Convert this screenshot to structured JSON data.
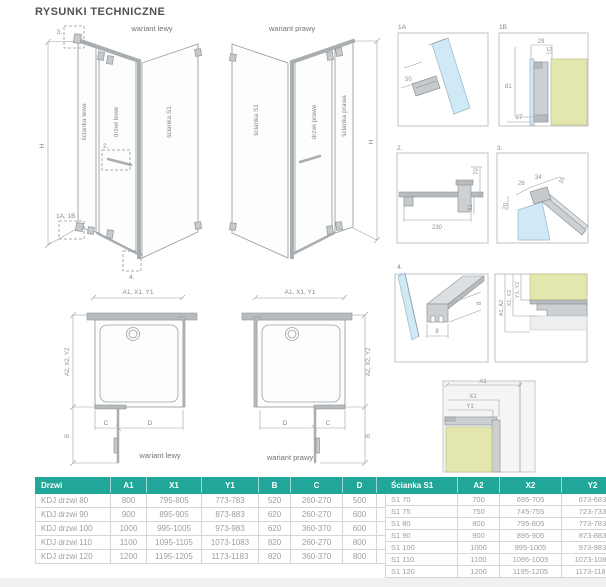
{
  "page": {
    "title": "RYSUNKI TECHNICZNE"
  },
  "colors": {
    "accent": "#21a69a",
    "glass": "#cfe9f6",
    "wall": "#e4e7ad",
    "line": "#9aa0a3"
  },
  "views": {
    "left3d": {
      "variant_label": "wariant lewy",
      "panel_left": "ścianka lewa",
      "panel_door": "drzwi lewe",
      "panel_s1": "ścianka S1",
      "dim_height": "H",
      "callout_top": "3.",
      "callout_handle": "2.",
      "callout_hinge": "1A, 1B",
      "callout_bottom": "4."
    },
    "right3d": {
      "variant_label": "wariant prawy",
      "panel_s1": "ścianka S1",
      "panel_door": "drzwi prawe",
      "panel_right": "ścianka prawa",
      "dim_height": "H"
    },
    "left_plan": {
      "variant_label": "wariant lewy",
      "dim_top": "A1, X1, Y1",
      "dim_side": "A2, X2, Y2",
      "dim_b": "B",
      "dim_c": "C",
      "dim_d": "D"
    },
    "right_plan": {
      "variant_label": "wariant prawy",
      "dim_top": "A1, X1, Y1",
      "dim_side": "A2, X2, Y2",
      "dim_b": "B",
      "dim_c": "C",
      "dim_d": "D"
    }
  },
  "details": {
    "d1a": {
      "label": "1A",
      "dim_50": "50"
    },
    "d1b": {
      "label": "1B",
      "dim_29": "29",
      "dim_12": "12",
      "dim_81": "81",
      "dim_27": "27"
    },
    "d2": {
      "label": "2.",
      "dim_70": "70",
      "dim_31": "31",
      "dim_230": "230"
    },
    "d3": {
      "label": "3.",
      "dim_26": "26",
      "dim_34": "34",
      "dim_16": "16",
      "dim_20": "20"
    },
    "d4": {
      "label": "4.",
      "dim_w": "8",
      "dim_h": "8"
    },
    "d5": {
      "dim_a": "A1, A2",
      "dim_x": "X1, X2",
      "dim_y": "Y1, Y2"
    },
    "corner": {
      "dim_a1": "A1",
      "dim_x1": "X1",
      "dim_y1": "Y1"
    }
  },
  "tables": {
    "doors": {
      "headers": [
        "Drzwi",
        "A1",
        "X1",
        "Y1",
        "B",
        "C",
        "D",
        "H"
      ],
      "rows": [
        [
          "KDJ drzwi 80",
          "800",
          "795-805",
          "773-783",
          "520",
          "260-270",
          "500",
          "2000"
        ],
        [
          "KDJ drzwi 90",
          "900",
          "895-905",
          "873-883",
          "620",
          "260-270",
          "600",
          "2000"
        ],
        [
          "KDJ drzwi 100",
          "1000",
          "995-1005",
          "973-983",
          "620",
          "360-370",
          "600",
          "2000"
        ],
        [
          "KDJ drzwi 110",
          "1100",
          "1095-1105",
          "1073-1083",
          "820",
          "260-270",
          "800",
          "2000"
        ],
        [
          "KDJ drzwi 120",
          "1200",
          "1195-1205",
          "1173-1183",
          "820",
          "360-370",
          "800",
          "2000"
        ]
      ]
    },
    "walls": {
      "headers": [
        "Ścianka S1",
        "A2",
        "X2",
        "Y2"
      ],
      "rows": [
        [
          "S1 70",
          "700",
          "695-705",
          "673-683"
        ],
        [
          "S1 75",
          "750",
          "745-755",
          "723-733"
        ],
        [
          "S1 80",
          "800",
          "795-805",
          "773-783"
        ],
        [
          "S1 90",
          "900",
          "895-905",
          "873-883"
        ],
        [
          "S1 100",
          "1000",
          "995-1005",
          "973-983"
        ],
        [
          "S1 110",
          "1100",
          "1095-1005",
          "1073-1083"
        ],
        [
          "S1 120",
          "1200",
          "1195-1205",
          "1173-1183"
        ]
      ]
    }
  }
}
